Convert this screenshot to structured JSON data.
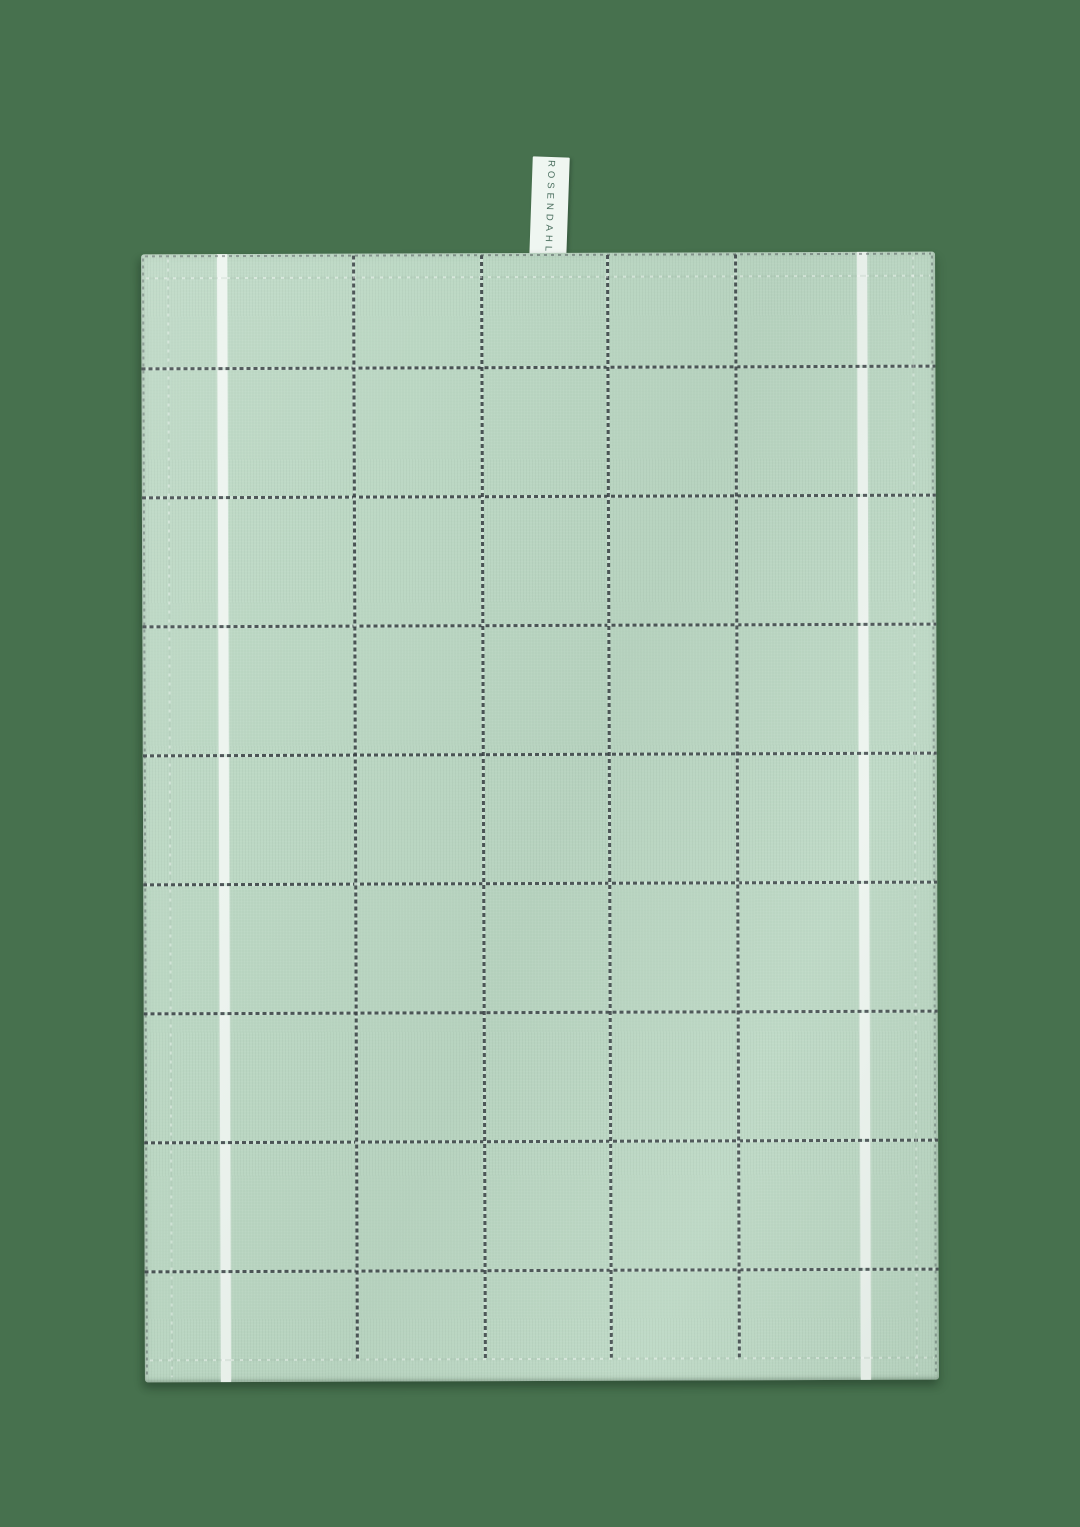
{
  "label": {
    "brand": "ROSENDAHL"
  },
  "colors": {
    "background": "#47714E",
    "towel": "#BCD8C4",
    "stripe": "#EDF4EF",
    "grid": "#3A4145",
    "grid_gap": "#D3E6DA",
    "label_bg": "#EFF6F1",
    "label_text": "#4C7060"
  },
  "layout": {
    "canvas": {
      "width": 1080,
      "height": 1527
    },
    "towel": {
      "left": 143,
      "top": 253,
      "width": 794,
      "height": 1128,
      "rotate_deg": -0.2
    },
    "label_tab": {
      "left": 531,
      "top": 157,
      "width": 37,
      "height": 102,
      "rotate_deg": 2
    },
    "hem_inset": 23
  },
  "pattern": {
    "white_stripes_x": [
      76,
      716
    ],
    "stripe_width": 10,
    "dark_vertical_x": [
      211,
      339,
      465,
      593
    ],
    "dark_horizontal_y": [
      113,
      242,
      371,
      500,
      629,
      758,
      887,
      1016
    ],
    "edge_vertical_x": [
      1,
      790
    ],
    "edge_horizontal_y": [
      1
    ],
    "line_thickness": 3
  }
}
